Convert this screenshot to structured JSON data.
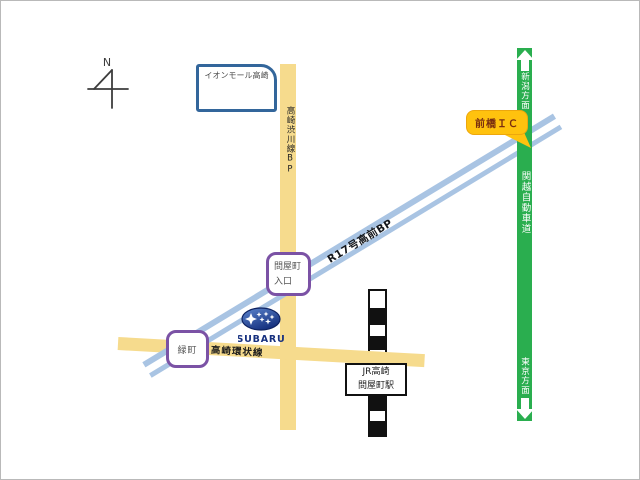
{
  "map": {
    "compass": {
      "label": "N"
    },
    "landmarks": {
      "aeon_mall": {
        "label": "イオンモール高崎"
      },
      "maebashi_ic": {
        "label": "前橋ＩＣ"
      },
      "tonyamachi_entrance": {
        "line1": "問屋町",
        "line2": "入口"
      },
      "midoricho": {
        "label": "緑町"
      },
      "station": {
        "line1": "JR高崎",
        "line2": "問屋町駅"
      },
      "subaru_dealer": {
        "label": "SUBARU"
      }
    },
    "roads": {
      "takasaki_shibukawa_bp": {
        "label": "高崎渋川線BP"
      },
      "r17_takamae_bp": {
        "label": "R17号高前BP"
      },
      "takasaki_kanjo_line": {
        "label": "高崎環状線"
      },
      "kanetsu_expressway": {
        "label": "関越自動車道",
        "north": "新潟方面",
        "south": "東京方面"
      }
    },
    "colors": {
      "local_road": "#F6DB8D",
      "expressway": "#2AAE4F",
      "bypass": "#A9C4E3",
      "ic_callout": "#FFC20E",
      "entrance_border": "#7B52A5",
      "landmark_border": "#33669B",
      "subaru_blue": "#16307F"
    }
  }
}
